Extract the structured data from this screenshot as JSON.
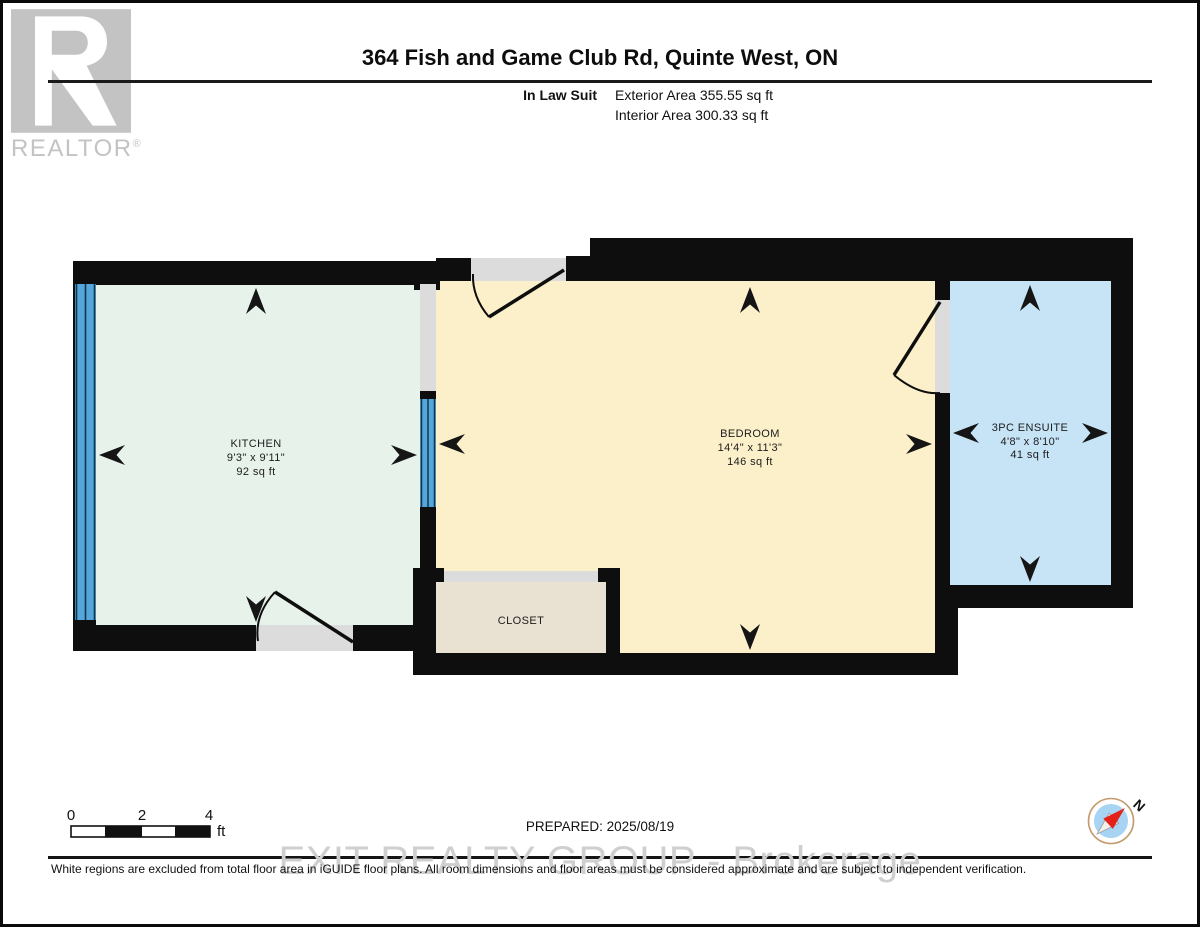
{
  "header": {
    "title": "364 Fish and Game Club Rd, Quinte West, ON",
    "suite_label": "In Law Suit",
    "exterior_area": "Exterior Area 355.55 sq ft",
    "interior_area": "Interior Area 300.33 sq ft"
  },
  "logo": {
    "brand": "REALTOR",
    "registered": "®"
  },
  "rooms": {
    "kitchen": {
      "name": "KITCHEN",
      "dimensions": "9'3\" x 9'11\"",
      "area": "92 sq ft",
      "color": "#e7f2eb"
    },
    "bedroom": {
      "name": "BEDROOM",
      "dimensions": "14'4\" x 11'3\"",
      "area": "146 sq ft",
      "color": "#fbf0ca"
    },
    "ensuite": {
      "name": "3PC ENSUITE",
      "dimensions": "4'8\" x 8'10\"",
      "area": "41 sq ft",
      "color": "#c7e4f7"
    },
    "closet": {
      "name": "CLOSET",
      "color": "#e9e1d2"
    }
  },
  "palette": {
    "wall": "#0e0e0e",
    "door_gap": "#dcdcdc",
    "window": "#55a7db",
    "window_line": "#16354d"
  },
  "scale_bar": {
    "ticks": [
      "0",
      "2",
      "4"
    ],
    "unit": "ft"
  },
  "compass": {
    "north_label": "N"
  },
  "footer": {
    "prepared": "PREPARED: 2025/08/19",
    "watermark": "EXIT REALTY GROUP - Brokerage",
    "disclaimer": "White regions are excluded from total floor area in iGUIDE floor plans. All room dimensions and floor areas must be considered approximate and are subject to independent verification."
  }
}
